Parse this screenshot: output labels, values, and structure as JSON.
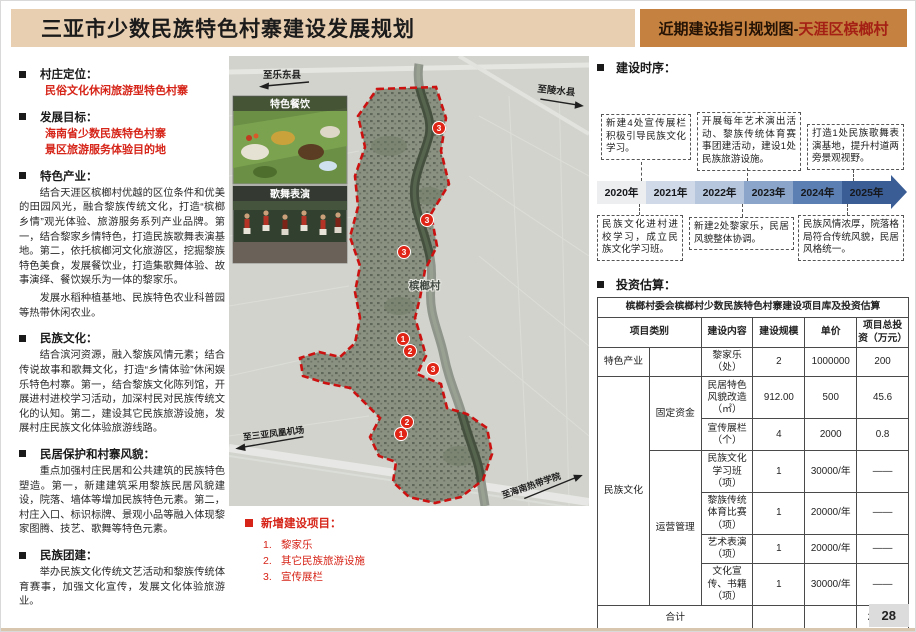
{
  "header": {
    "title": "三亚市少数民族特色村寨建设发展规划",
    "right_prefix": "近期建设指引规划图-",
    "right_highlight": "天涯区槟榔村"
  },
  "colors": {
    "header_left_bg": "#e9cfb2",
    "header_right_bg": "#c5813f",
    "accent_red": "#d62418",
    "boundary_red": "#cc1111",
    "timeline_dark_blue": "#3a5d96"
  },
  "left_panel": {
    "sections": [
      {
        "title": "村庄定位：",
        "red1": "民俗文化休闲旅游型特色村寨"
      },
      {
        "title": "发展目标：",
        "red1": "海南省少数民族特色村寨",
        "red2": "景区旅游服务体验目的地"
      },
      {
        "title": "特色产业：",
        "p1": "结合天涯区槟榔村优越的区位条件和优美的田园风光，融合黎族传统文化，打造“槟榔乡情”观光体验、旅游服务系列产业品牌。第一，结合黎家乡情特色，打造民族歌舞表演基地。第二，依托槟榔河文化旅游区，挖掘黎族特色美食，发展餐饮业，打造集歌舞体验、故事演绎、餐饮娱乐为一体的黎家乐。",
        "p2": "发展水稻种植基地、民族特色农业科普园等热带休闲农业。"
      },
      {
        "title": "民族文化：",
        "p1": "结合滨河资源，融入黎族风情元素；结合传说故事和歌舞文化，打造“乡情体验”休闲娱乐特色村寨。第一，结合黎族文化陈列馆，开展进村进校学习活动，加深村民对民族传统文化的认知。第二，建设其它民族旅游设施，发展村庄民族文化体验旅游线路。"
      },
      {
        "title": "民居保护和村寨风貌：",
        "p1": "重点加强村庄民居和公共建筑的民族特色塑造。第一，新建建筑采用黎族民居风貌建设，院落、墙体等增加民族特色元素。第二，村庄入口、标识标牌、景观小品等融入体现黎家图腾、技艺、歌舞等特色元素。"
      },
      {
        "title": "民族团建：",
        "p1": "举办民族文化传统文艺活动和黎族传统体育赛事，加强文化宣传，发展文化体验旅游业。"
      }
    ]
  },
  "map": {
    "labels": {
      "to_ledong": "至乐东县",
      "to_lingshui": "至陵水县",
      "village": "槟榔村",
      "to_airport": "至三亚凤凰机场",
      "to_college": "至海南热带学院"
    },
    "insets": [
      {
        "title": "特色餐饮"
      },
      {
        "title": "歌舞表演"
      }
    ],
    "markers": [
      {
        "num": "3"
      },
      {
        "num": "3"
      },
      {
        "num": "3"
      },
      {
        "num": "1"
      },
      {
        "num": "2"
      },
      {
        "num": "3"
      },
      {
        "num": "2"
      },
      {
        "num": "1"
      }
    ],
    "legend": {
      "title": "新增建设项目：",
      "items": [
        {
          "num": "1.",
          "label": "黎家乐"
        },
        {
          "num": "2.",
          "label": "其它民族旅游设施"
        },
        {
          "num": "3.",
          "label": "宣传展栏"
        }
      ]
    }
  },
  "timeline": {
    "section_title": "建设时序：",
    "top_boxes": [
      "新建4处宣传展栏积极引导民族文化学习。",
      "开展每年艺术演出活动、黎族传统体育赛事团建活动，建设1处民族旅游设施。",
      "打造1处民族歌舞表演基地，提升村道两旁景观视野。"
    ],
    "years": [
      "2020年",
      "2021年",
      "2022年",
      "2023年",
      "2024年",
      "2025年"
    ],
    "bottom_boxes": [
      "民族文化进村进校学习，成立民族文化学习班。",
      "新建2处黎家乐，民居风貌整体协调。",
      "民族风情浓厚，院落格局符合传统风貌，民居风格统一。"
    ]
  },
  "invest": {
    "section_title": "投资估算：",
    "table_title": "槟榔村委会槟榔村少数民族特色村寨建设项目库及投资估算",
    "headers": {
      "category": "项目类别",
      "content": "建设内容",
      "scale": "建设规模",
      "unit_price": "单价",
      "total": "项目总投资（万元）"
    },
    "cat_feature": "特色产业",
    "cat_culture": "民族文化",
    "cat_fixed": "固定资金",
    "cat_operate": "运营管理",
    "rows": [
      {
        "content": "黎家乐（处）",
        "scale": "2",
        "unit": "1000000",
        "total": "200"
      },
      {
        "content": "民居特色风貌改造（㎡）",
        "scale": "912.00",
        "unit": "500",
        "total": "45.6"
      },
      {
        "content": "宣传展栏（个）",
        "scale": "4",
        "unit": "2000",
        "total": "0.8"
      },
      {
        "content": "民族文化学习班（项）",
        "scale": "1",
        "unit": "30000/年",
        "total": "——"
      },
      {
        "content": "黎族传统体育比赛（项）",
        "scale": "1",
        "unit": "20000/年",
        "total": "——"
      },
      {
        "content": "艺术表演（项）",
        "scale": "1",
        "unit": "20000/年",
        "total": "——"
      },
      {
        "content": "文化宣传、书籍（项）",
        "scale": "1",
        "unit": "30000/年",
        "total": "——"
      }
    ],
    "total_label": "合计",
    "total_value": "246.40"
  },
  "page_number": "28"
}
